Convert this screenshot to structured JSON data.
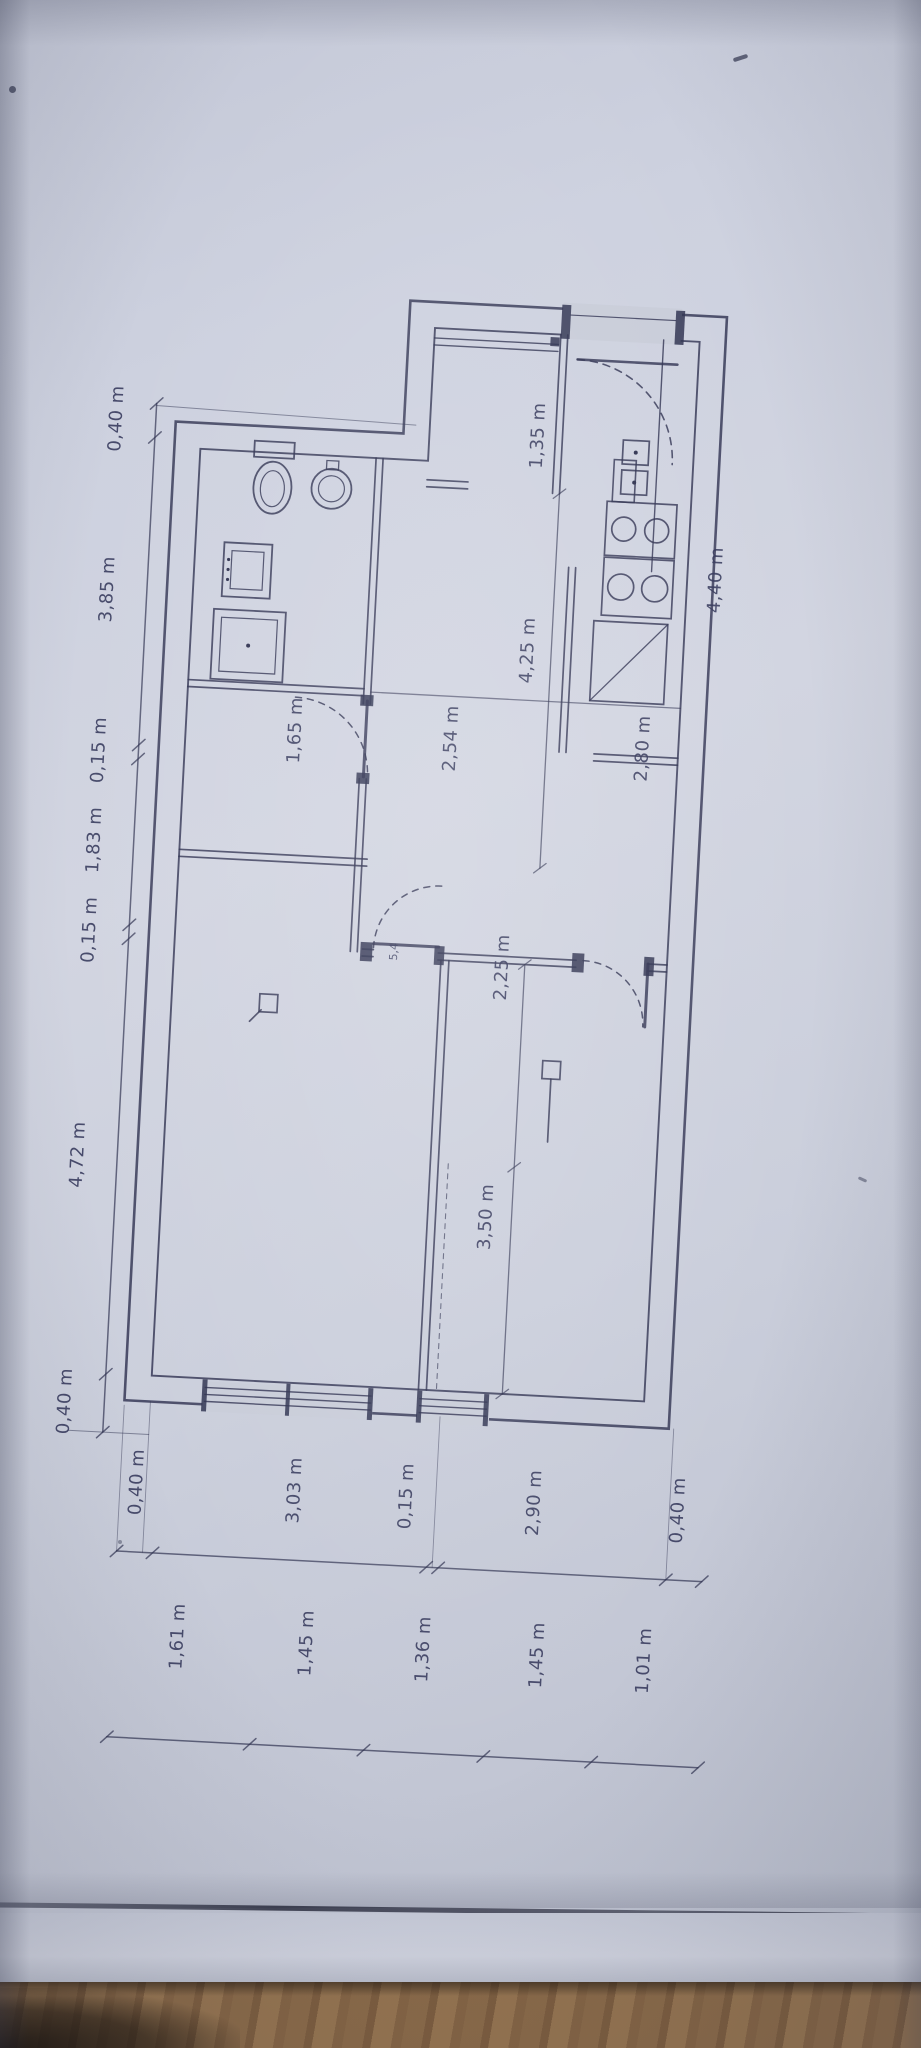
{
  "colors": {
    "paper": "#cbcfdc",
    "ink": "#2e3150",
    "wood": "#8a6a49"
  },
  "plan": {
    "unit_note": "m",
    "chains": {
      "left": {
        "labels": [
          "0,40 m",
          "3,85 m",
          "0,15 m",
          "1,83 m",
          "0,15 m",
          "4,72 m",
          "0,40 m"
        ]
      },
      "bottom_inner": {
        "labels": [
          "0,40 m",
          "3,03 m",
          "0,15 m",
          "2,90 m",
          "0,40 m"
        ]
      },
      "bottom_outer": {
        "labels": [
          "1,61 m",
          "1,45 m",
          "1,36 m",
          "1,45 m",
          "1,01 m"
        ]
      }
    },
    "interior_labels": {
      "vestibule": "1,35 m",
      "wing_depth": "4,40 m",
      "hall_length": "4,25 m",
      "hall_width": "2,54 m",
      "bath_door": "1,65 m",
      "kitchen": "2,80 m",
      "room_width": "2,25 m",
      "room_length": "3,50 m",
      "door_scribble": "5,4"
    }
  }
}
